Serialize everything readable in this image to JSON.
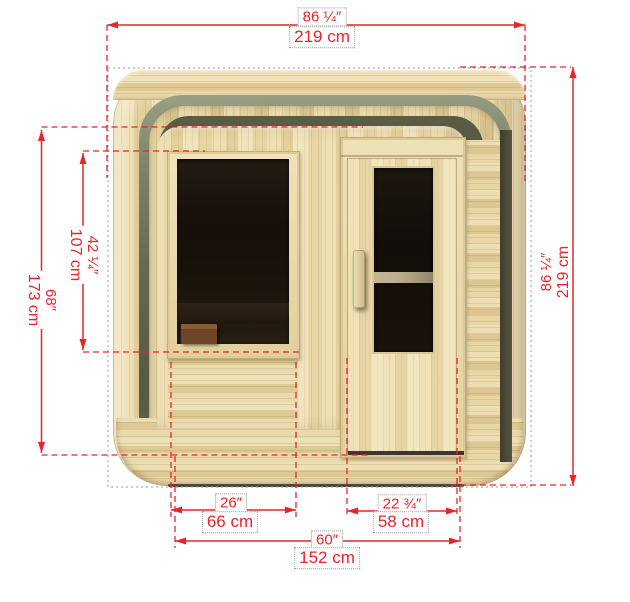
{
  "dimensions": {
    "overall_width": {
      "inches": "86 ¼″",
      "cm": "219 cm"
    },
    "overall_height": {
      "inches": "86 ¼″",
      "cm": "219 cm"
    },
    "wall_height": {
      "inches": "68″",
      "cm": "173 cm"
    },
    "window_height": {
      "inches": "42 ¼″",
      "cm": "107 cm"
    },
    "window_width": {
      "inches": "26″",
      "cm": "66 cm"
    },
    "door_width": {
      "inches": "22 ¾″",
      "cm": "58 cm"
    },
    "base_width": {
      "inches": "60″",
      "cm": "152 cm"
    }
  },
  "colors": {
    "dimension_red": "#e62529",
    "guide_gray": "#9b9b9b",
    "wood_light": "#eedfb2",
    "wood_mid": "#e0cb97",
    "arch_shadow_olive": "#575944",
    "glass_dark": "#160f0a",
    "background": "#ffffff"
  }
}
